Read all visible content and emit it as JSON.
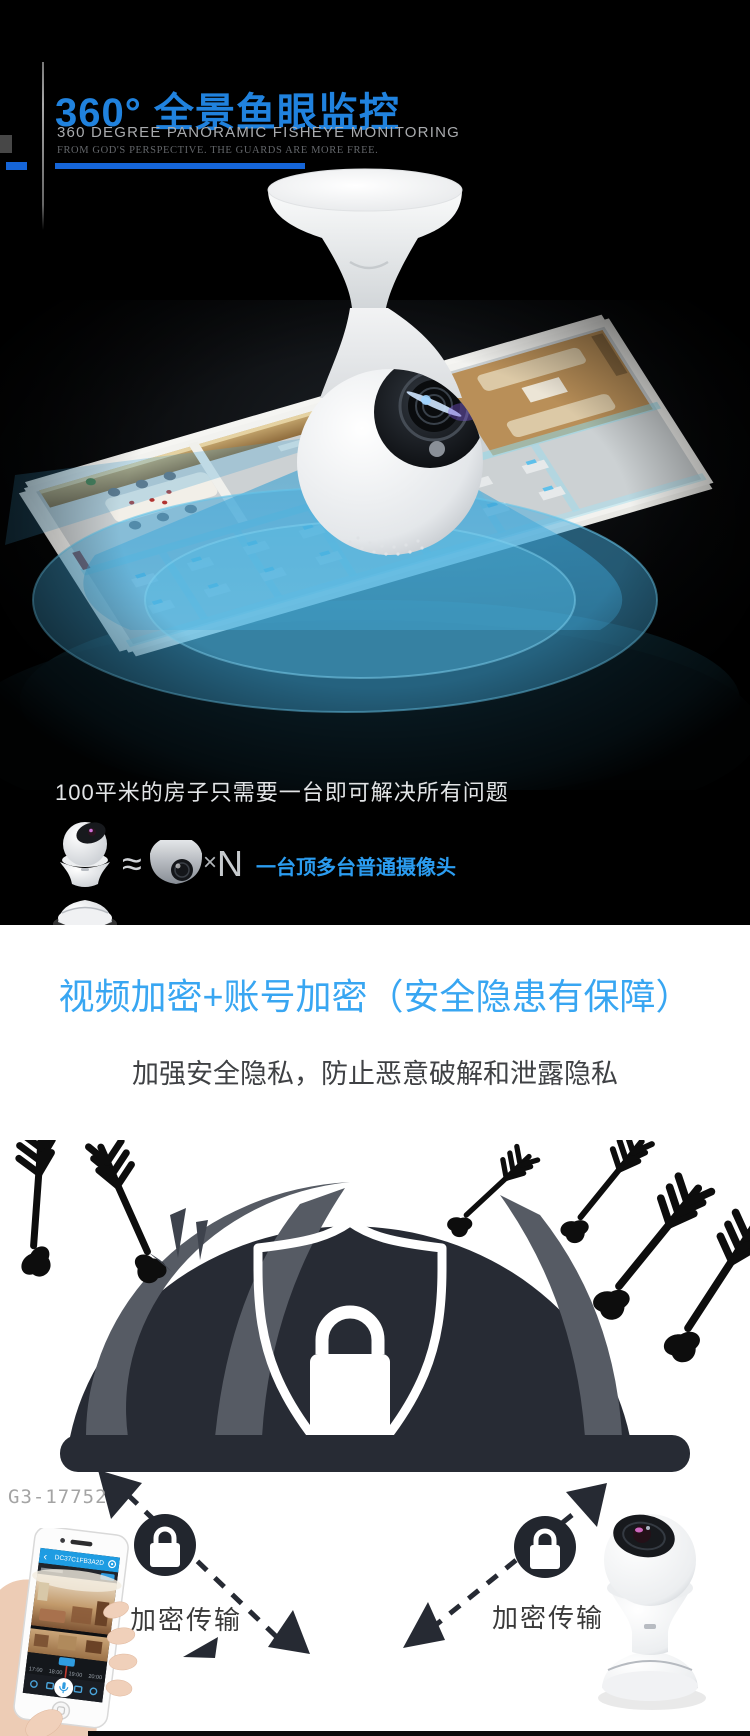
{
  "hero_section": {
    "title": "360°  全景鱼眼监控",
    "subtitle": "360 DEGREE PANORAMIC FISHEYE MONITORING",
    "tagline": "FROM GOD'S PERSPECTIVE. THE GUARDS ARE MORE FREE.",
    "caption": "100平米的房子只需要一台即可解决所有问题",
    "compare": {
      "approx": "≈",
      "times": "×",
      "multiplier": "N",
      "label": "一台顶多台普通摄像头"
    },
    "accent_blue": "#2082de",
    "underline_blue": "#1565d8",
    "label_blue": "#2b9cf0",
    "beam_blue": "#41aadc"
  },
  "security_section": {
    "headline": "视频加密+账号加密（安全隐患有保障）",
    "subheadline": "加强安全隐私，防止恶意破解和泄露隐私",
    "watermark": "G3-17752",
    "captions": {
      "left": "加密传输",
      "right": "加密传输"
    },
    "headline_blue": "#38a6f2",
    "dome_dark": "#272b34",
    "dome_gray": "#565b64"
  },
  "phone_app": {
    "back_glyph": "‹",
    "title": "DC37C1FB3A2D",
    "timeline_labels": [
      "17:00",
      "18:00",
      "19:00",
      "20:00"
    ],
    "header_blue": "#1e9ce2"
  }
}
